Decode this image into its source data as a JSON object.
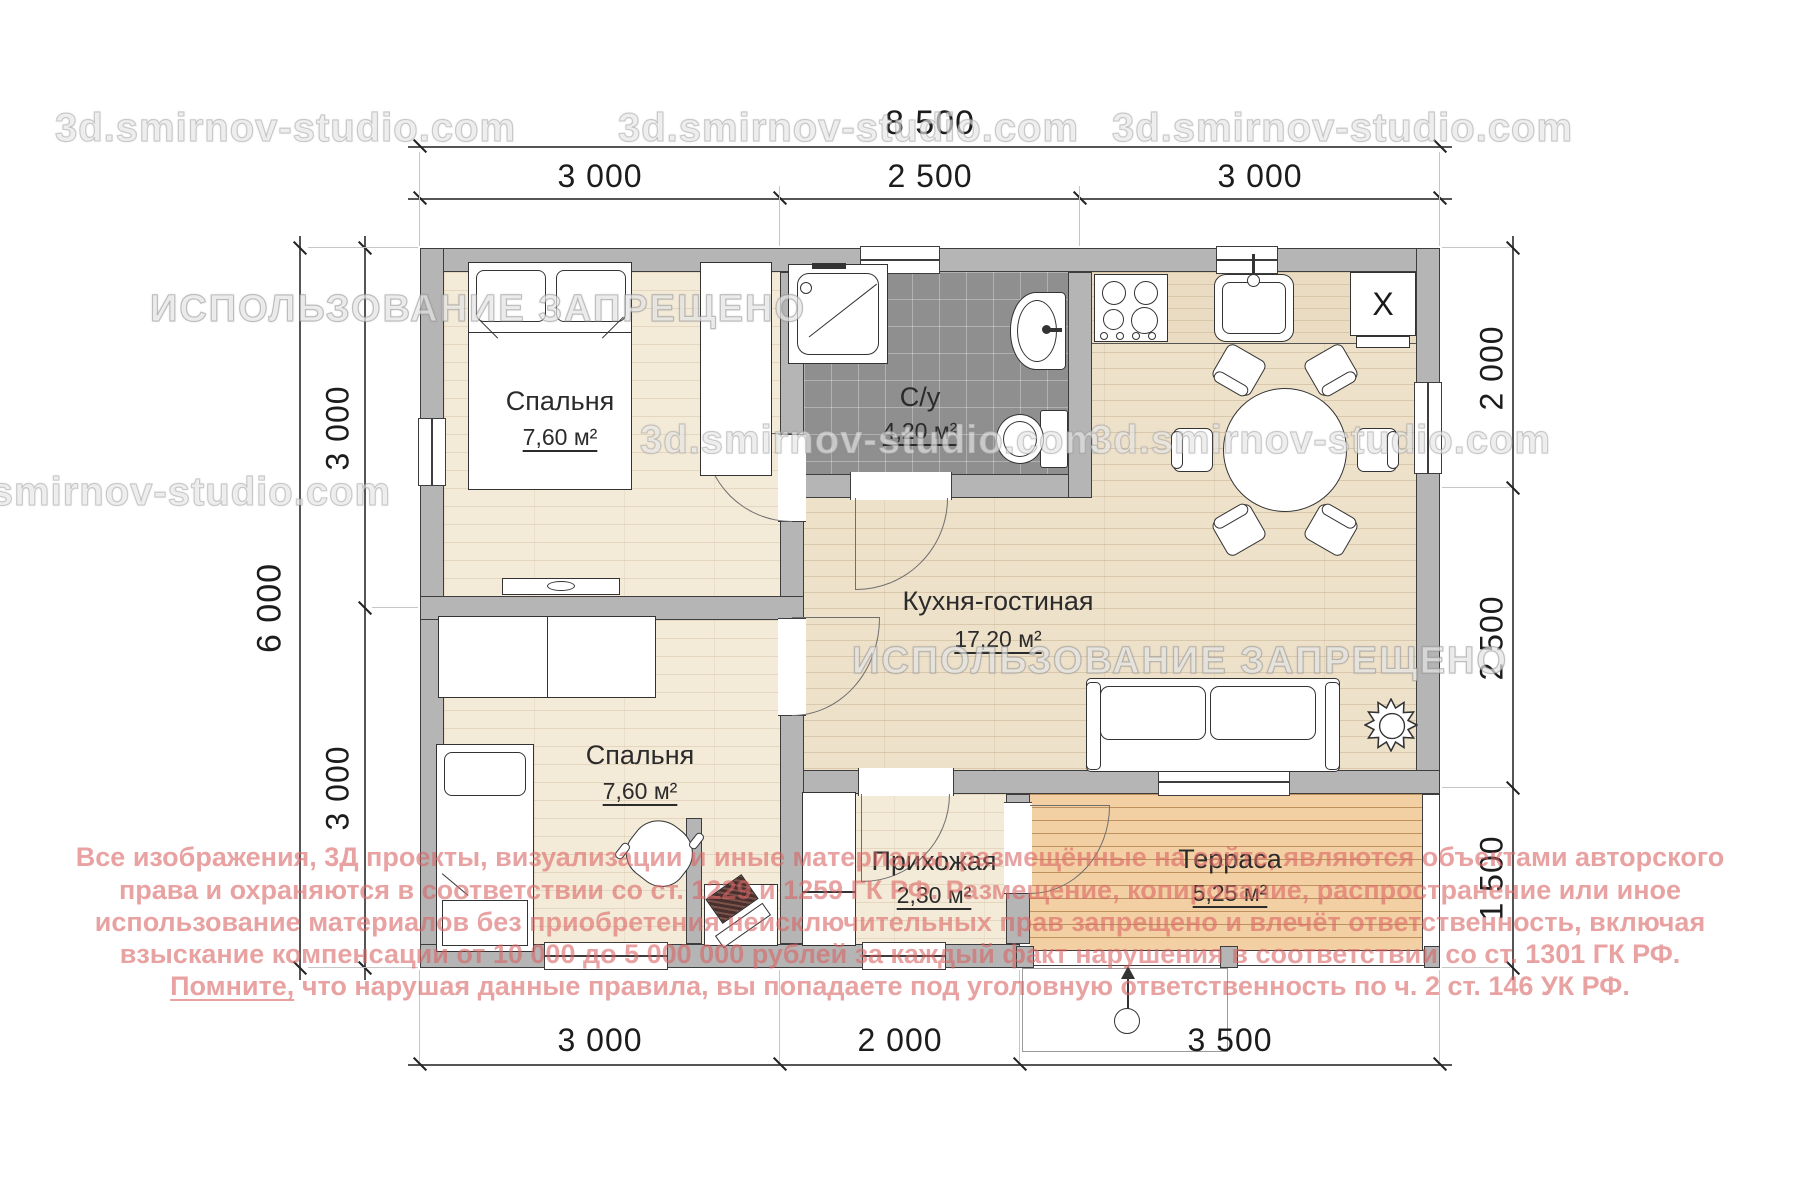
{
  "dimensions": {
    "top_total": "8 500",
    "top_segments": [
      "3 000",
      "2 500",
      "3 000"
    ],
    "left_total": "6 000",
    "left_segments": [
      "3 000",
      "3 000"
    ],
    "right_segments": [
      "2 000",
      "2 500",
      "1 500"
    ],
    "bottom_segments": [
      "3 000",
      "2 000",
      "3 500"
    ]
  },
  "rooms": {
    "bedroom1": {
      "name": "Спальня",
      "area": "7,60 м²"
    },
    "bathroom": {
      "name": "С/у",
      "area": "4,20 м²"
    },
    "kitchen_living": {
      "name": "Кухня-гостиная",
      "area": "17,20 м²"
    },
    "bedroom2": {
      "name": "Спальня",
      "area": "7,60 м²"
    },
    "hallway": {
      "name": "Прихожая",
      "area": "2,30 м²"
    },
    "terrace": {
      "name": "Терраса",
      "area": "5,25 м²"
    }
  },
  "labels": {
    "cabinet_x": "X"
  },
  "watermarks": {
    "site": "3d.smirnov-studio.com",
    "forbidden": "ИСПОЛЬЗОВАНИЕ ЗАПРЕЩЕНО"
  },
  "copyright": {
    "line1": "Все изображения, 3Д проекты, визуализации и иные материалы, размещённые на сайте, являются объектами авторского",
    "line2": "права и охраняются в соответствии со ст. 1229 и 1259 ГК РФ. Размещение, копирование, распространение или иное",
    "line3": "использование материалов без приобретения неисключительных прав запрещено и влечёт ответственность, включая",
    "line4": "взыскание компенсации от 10 000 до 5 000 000 рублей за каждый факт нарушения в соответствии со ст. 1301 ГК РФ.",
    "line5_lead": "Помните,",
    "line5_rest": " что нарушая данные правила, вы попадаете под уголовную ответственность по ч. 2 ст. 146 УК РФ."
  },
  "colors": {
    "wall_fill": "#b5b5b5",
    "wall_line": "#3d3d3d",
    "floor_wood": "#eee1c9",
    "floor_bedroom": "#f4ead8",
    "bath_tile": "#8f8f8f",
    "terrace_deck": "#f3d0a3",
    "copyright_red": "#db6464",
    "watermark_gray": "#c7c7c7"
  }
}
